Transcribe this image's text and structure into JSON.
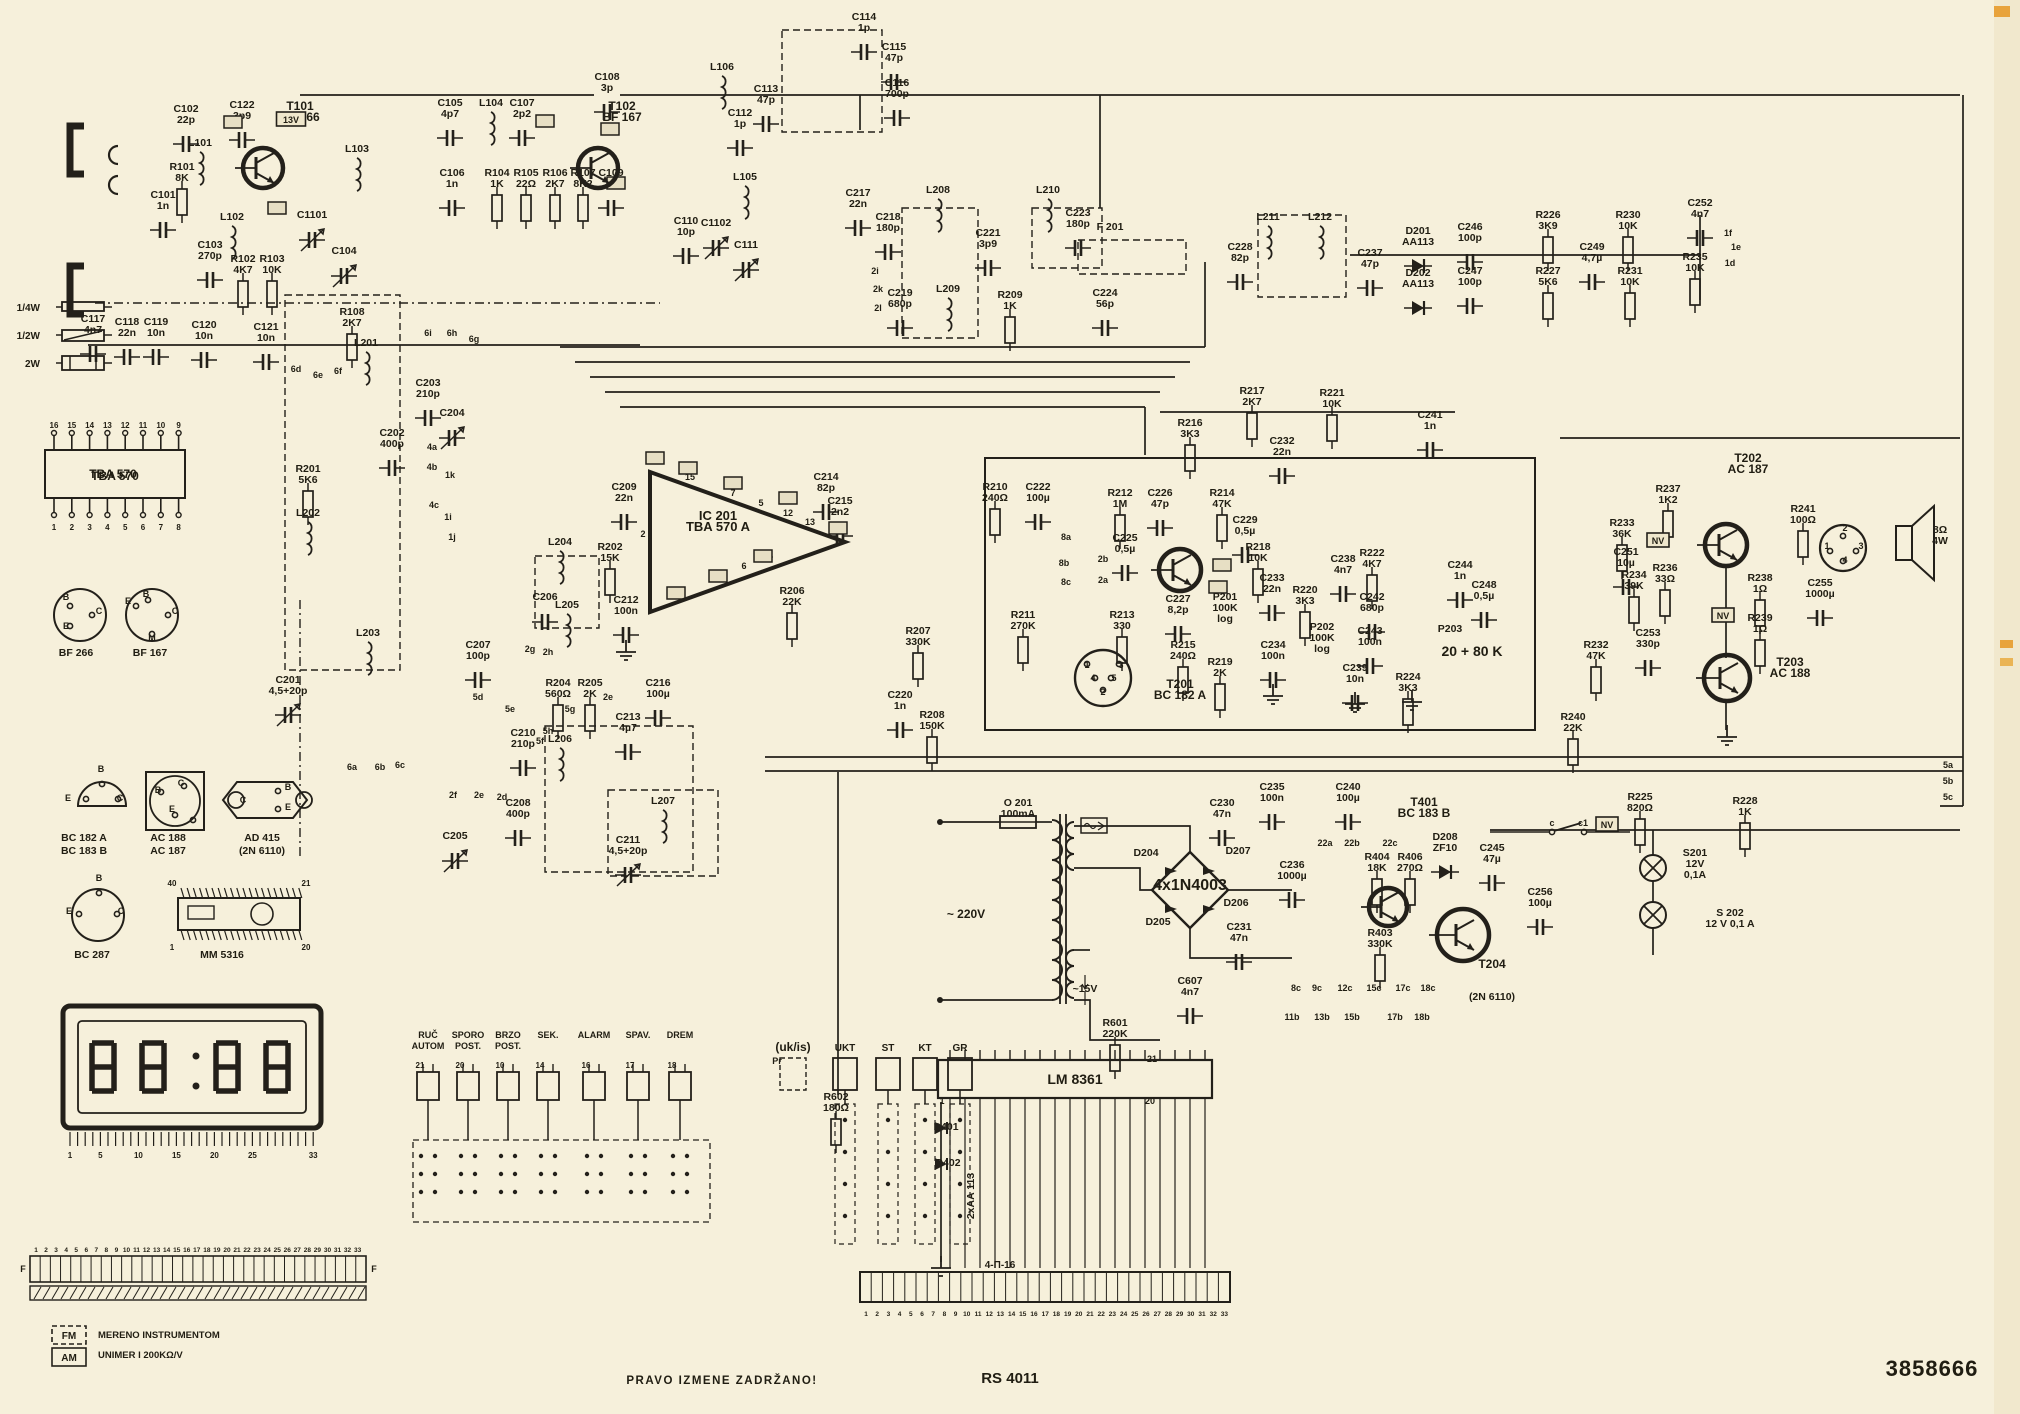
{
  "footer": {
    "note": "PRAVO  IZMENE  ZADRŽANO!",
    "model": "RS 4011",
    "number": "3858666"
  },
  "colors": {
    "paper": "#f6f0db",
    "ink": "#23201a",
    "accent_orange": "#e8a33c"
  },
  "display": {
    "value": "88:88",
    "scale": [
      "1",
      "5",
      "10",
      "15",
      "20",
      "25",
      "33"
    ]
  },
  "ics": {
    "tba570": {
      "label": "TBA 570",
      "pins_top": [
        "16",
        "15",
        "14",
        "13",
        "12",
        "11",
        "10",
        "9"
      ],
      "pins_bottom": [
        "1",
        "2",
        "3",
        "4",
        "5",
        "6",
        "7",
        "8"
      ]
    },
    "mm5316": {
      "label": "MM 5316",
      "pin_tl": "40",
      "pin_tr": "21",
      "pin_bl": "1",
      "pin_br": "20"
    },
    "lm8361": {
      "label": "LM 8361"
    }
  },
  "connectors": {
    "left_strip_numbers": [
      "1",
      "2",
      "3",
      "4",
      "5",
      "6",
      "7",
      "8",
      "9",
      "10",
      "11",
      "12",
      "13",
      "14",
      "15",
      "16",
      "17",
      "18",
      "19",
      "20",
      "21",
      "22",
      "23",
      "24",
      "25",
      "26",
      "27",
      "28",
      "29",
      "30",
      "31",
      "32",
      "33"
    ],
    "left_strip_end_letters": [
      "F",
      "F"
    ],
    "main_strip_numbers": [
      "1",
      "2",
      "3",
      "4",
      "5",
      "6",
      "7",
      "8",
      "9",
      "10",
      "11",
      "12",
      "13",
      "14",
      "15",
      "16",
      "17",
      "18",
      "19",
      "20",
      "21",
      "22",
      "23",
      "24",
      "25",
      "26",
      "27",
      "28",
      "29",
      "30",
      "31",
      "32",
      "33"
    ],
    "main_strip_tag": "4-Π-16"
  },
  "clock_switches": {
    "labels": [
      "RUČ|AUTOM",
      "SPORO|POST.",
      "BRZO|POST.",
      "SEK.",
      "ALARM",
      "SPAV.",
      "DREM"
    ],
    "pins": [
      "21",
      "20",
      "10",
      "14",
      "16",
      "17",
      "18"
    ]
  },
  "band_switches": {
    "prefix": "Pr",
    "group": "(uk/is)",
    "labels": [
      "UKT",
      "ST",
      "KT",
      "GR"
    ]
  },
  "legend": {
    "items": [
      "1/4W",
      "1/2W",
      "2W"
    ]
  },
  "meter_note": {
    "fm": "FM",
    "am": "AM",
    "line1": "MERENO  INSTRUMENTOM",
    "line2": "UNIMER I  200KΩ/V"
  },
  "voltage_tags": [
    [
      "13V",
      291,
      122
    ],
    [
      "NV",
      1658,
      543
    ],
    [
      "NV",
      1723,
      618
    ],
    [
      "NV",
      1607,
      827
    ]
  ],
  "empty_tags": [
    [
      233,
      122
    ],
    [
      545,
      121
    ],
    [
      610,
      129
    ],
    [
      277,
      208
    ],
    [
      616,
      183
    ],
    [
      655,
      458
    ],
    [
      688,
      468
    ],
    [
      733,
      483
    ],
    [
      788,
      498
    ],
    [
      838,
      528
    ],
    [
      763,
      556
    ],
    [
      718,
      576
    ],
    [
      676,
      593
    ],
    [
      1222,
      565
    ],
    [
      1218,
      587
    ]
  ],
  "labels": [
    [
      "C101|1n",
      163,
      198
    ],
    [
      "L101",
      200,
      146
    ],
    [
      "L102",
      232,
      220
    ],
    [
      "C102|22p",
      186,
      112
    ],
    [
      "C122|3p9",
      242,
      108
    ],
    [
      "R101|8K",
      182,
      170
    ],
    [
      "T101|BF 266",
      300,
      110,
      {
        "b": 1,
        "s": 12,
        "g": 0
      }
    ],
    [
      "C103|270p",
      210,
      248
    ],
    [
      "R102|4K7",
      243,
      262
    ],
    [
      "R103|10K",
      272,
      262
    ],
    [
      "L103",
      357,
      152
    ],
    [
      "C1101",
      312,
      218,
      {
        "g": "trim"
      }
    ],
    [
      "C104",
      344,
      254,
      {
        "g": "trim"
      }
    ],
    [
      "C117|4n7",
      93,
      322
    ],
    [
      "C118|22n",
      127,
      325
    ],
    [
      "C119|10n",
      156,
      325
    ],
    [
      "C120|10n",
      204,
      328
    ],
    [
      "C121|10n",
      266,
      330
    ],
    [
      "R108|2K7",
      352,
      315
    ],
    [
      "C105|4p7",
      450,
      106
    ],
    [
      "L104",
      491,
      106
    ],
    [
      "C107|2p2",
      522,
      106
    ],
    [
      "T102|BF 167",
      622,
      110,
      {
        "b": 1,
        "s": 12,
        "g": 0
      }
    ],
    [
      "C106|1n",
      452,
      176
    ],
    [
      "R104|1K",
      497,
      176
    ],
    [
      "R105|22Ω",
      526,
      176
    ],
    [
      "R106|2K7",
      555,
      176
    ],
    [
      "R107|8K2",
      583,
      176
    ],
    [
      "C109|1n",
      611,
      176
    ],
    [
      "C108|3p",
      607,
      80
    ],
    [
      "L106",
      722,
      70
    ],
    [
      "C113|47p",
      766,
      92
    ],
    [
      "C112|1p",
      740,
      116
    ],
    [
      "C114|1p",
      864,
      20
    ],
    [
      "C115|47p",
      894,
      50
    ],
    [
      "C116|700p",
      897,
      86
    ],
    [
      "L105",
      745,
      180
    ],
    [
      "C110|10p",
      686,
      224
    ],
    [
      "C1102",
      716,
      226,
      {
        "g": "trim"
      }
    ],
    [
      "C111",
      746,
      248,
      {
        "g": "trim"
      }
    ],
    [
      "C217|22n",
      858,
      196
    ],
    [
      "C218|180p",
      888,
      220
    ],
    [
      "L208",
      938,
      193
    ],
    [
      "C221|3p9",
      988,
      236
    ],
    [
      "L210",
      1048,
      193
    ],
    [
      "C223|180p",
      1078,
      216
    ],
    [
      "F 201",
      1110,
      230,
      {
        "b": 1,
        "g": 0
      }
    ],
    [
      "L209",
      948,
      292
    ],
    [
      "C219|680p",
      900,
      296
    ],
    [
      "R209|1K",
      1010,
      298
    ],
    [
      "C224|56p",
      1105,
      296
    ],
    [
      "C228|82p",
      1240,
      250
    ],
    [
      "L211",
      1268,
      220
    ],
    [
      "L212",
      1320,
      220
    ],
    [
      "C237|47p",
      1370,
      256
    ],
    [
      "D201|AA113",
      1418,
      234
    ],
    [
      "D202|AA113",
      1418,
      276
    ],
    [
      "C246|100p",
      1470,
      230
    ],
    [
      "C247|100p",
      1470,
      274
    ],
    [
      "R226|3K9",
      1548,
      218
    ],
    [
      "R227|5K6",
      1548,
      274
    ],
    [
      "C249|4,7µ",
      1592,
      250
    ],
    [
      "R230|10K",
      1628,
      218
    ],
    [
      "R231|10K",
      1630,
      274
    ],
    [
      "C252|4n7",
      1700,
      206
    ],
    [
      "R235|10K",
      1695,
      260
    ],
    [
      "1f",
      1728,
      236
    ],
    [
      "1e",
      1736,
      250
    ],
    [
      "1d",
      1730,
      266
    ],
    [
      "R216|3K3",
      1190,
      426
    ],
    [
      "R217|2K7",
      1252,
      394
    ],
    [
      "C232|22n",
      1282,
      444
    ],
    [
      "R221|10K",
      1332,
      396
    ],
    [
      "C241|1n",
      1430,
      418
    ],
    [
      "IC 201|TBA 570 A",
      718,
      520,
      {
        "b": 1,
        "s": 13,
        "g": 0
      }
    ],
    [
      "C209|22n",
      624,
      490
    ],
    [
      "R202|15K",
      610,
      550
    ],
    [
      "C212|100n",
      626,
      603
    ],
    [
      "C214|82p",
      826,
      480
    ],
    [
      "C215|2n2",
      840,
      504
    ],
    [
      "R206|22K",
      792,
      594
    ],
    [
      "1",
      649,
      463
    ],
    [
      "15",
      690,
      480
    ],
    [
      "7",
      733,
      496
    ],
    [
      "5",
      761,
      506
    ],
    [
      "12",
      788,
      516
    ],
    [
      "13",
      810,
      525
    ],
    [
      "14",
      768,
      559
    ],
    [
      "6",
      744,
      569
    ],
    [
      "16",
      715,
      581
    ],
    [
      "4",
      676,
      597
    ],
    [
      "2",
      643,
      537
    ],
    [
      "L201",
      366,
      346
    ],
    [
      "C203|210p",
      428,
      386
    ],
    [
      "C204",
      452,
      416,
      {
        "g": "trim"
      }
    ],
    [
      "C202|400p",
      392,
      436
    ],
    [
      "R201|5K6",
      308,
      472
    ],
    [
      "L202",
      308,
      516
    ],
    [
      "C201|4,5+20p",
      288,
      683,
      {
        "g": "trim"
      }
    ],
    [
      "L203",
      368,
      636
    ],
    [
      "L204",
      560,
      545
    ],
    [
      "C206",
      545,
      600
    ],
    [
      "L205",
      567,
      608
    ],
    [
      "R204|560Ω",
      558,
      686
    ],
    [
      "R205|2K",
      590,
      686
    ],
    [
      "C216|100µ",
      658,
      686
    ],
    [
      "C213|4µ7",
      628,
      720
    ],
    [
      "C207|100p",
      478,
      648
    ],
    [
      "C210|210p",
      523,
      736
    ],
    [
      "L206",
      560,
      742
    ],
    [
      "L207",
      663,
      804
    ],
    [
      "C205",
      455,
      839,
      {
        "g": "trim"
      }
    ],
    [
      "C208|400p",
      518,
      806
    ],
    [
      "C211|4,5+20p",
      628,
      843,
      {
        "g": "trim"
      }
    ],
    [
      "6i",
      428,
      336
    ],
    [
      "6h",
      452,
      336
    ],
    [
      "6g",
      474,
      342
    ],
    [
      "6d",
      296,
      372
    ],
    [
      "6e",
      318,
      378
    ],
    [
      "6f",
      338,
      374
    ],
    [
      "4a",
      432,
      450
    ],
    [
      "4b",
      432,
      470
    ],
    [
      "4c",
      434,
      508
    ],
    [
      "1k",
      450,
      478
    ],
    [
      "1i",
      448,
      520
    ],
    [
      "1j",
      452,
      540
    ],
    [
      "2g",
      530,
      652
    ],
    [
      "2h",
      548,
      655
    ],
    [
      "2e",
      608,
      700
    ],
    [
      "5d",
      478,
      700
    ],
    [
      "5e",
      510,
      712
    ],
    [
      "5g",
      570,
      712
    ],
    [
      "5h",
      548,
      734
    ],
    [
      "5f",
      540,
      744
    ],
    [
      "6a",
      352,
      770
    ],
    [
      "6b",
      380,
      770
    ],
    [
      "6c",
      400,
      768
    ],
    [
      "2f",
      453,
      798
    ],
    [
      "2e",
      479,
      798
    ],
    [
      "2d",
      502,
      800
    ],
    [
      "2i",
      875,
      274
    ],
    [
      "2k",
      878,
      292
    ],
    [
      "2l",
      878,
      311
    ],
    [
      "8a",
      1066,
      540
    ],
    [
      "8b",
      1064,
      566
    ],
    [
      "8c",
      1066,
      585
    ],
    [
      "2b",
      1103,
      562
    ],
    [
      "2a",
      1103,
      583
    ],
    [
      "R210|240Ω",
      995,
      490
    ],
    [
      "C222|100µ",
      1038,
      490
    ],
    [
      "R212|1M",
      1120,
      496
    ],
    [
      "C226|47p",
      1160,
      496
    ],
    [
      "R214|47K",
      1222,
      496
    ],
    [
      "C225|0,5µ",
      1125,
      541
    ],
    [
      "C229|0,5µ",
      1245,
      523
    ],
    [
      "R218|10K",
      1258,
      550
    ],
    [
      "P201|100K|log",
      1225,
      600,
      {
        "g": 0
      }
    ],
    [
      "C233|22n",
      1272,
      581
    ],
    [
      "R220|3K3",
      1305,
      593
    ],
    [
      "C234|100n",
      1273,
      648
    ],
    [
      "R219|2K",
      1220,
      665
    ],
    [
      "R211|270K",
      1023,
      618
    ],
    [
      "R213|330",
      1122,
      618
    ],
    [
      "C227|8,2p",
      1178,
      602
    ],
    [
      "R215|240Ω",
      1183,
      648
    ],
    [
      "T201|BC 182 A",
      1180,
      688,
      {
        "b": 1,
        "s": 12,
        "g": 0
      }
    ],
    [
      "P202|100K|log",
      1322,
      630,
      {
        "g": 0
      }
    ],
    [
      "C239|10n",
      1355,
      671
    ],
    [
      "C238|4n7",
      1343,
      562
    ],
    [
      "R222|4K7",
      1372,
      556
    ],
    [
      "C242|680p",
      1372,
      600
    ],
    [
      "C243|100n",
      1370,
      634
    ],
    [
      "R224|3K3",
      1408,
      680
    ],
    [
      "C244|1n",
      1460,
      568
    ],
    [
      "C248|0,5µ",
      1484,
      588
    ],
    [
      "P203",
      1450,
      632,
      {
        "g": 0
      }
    ],
    [
      "20 + 80 K",
      1472,
      656,
      {
        "b": 1,
        "s": 14,
        "g": 0
      }
    ],
    [
      "R207|330K",
      918,
      634
    ],
    [
      "C220|1n",
      900,
      698
    ],
    [
      "R208|150K",
      932,
      718
    ],
    [
      "1",
      1087,
      668
    ],
    [
      "3",
      1121,
      668
    ],
    [
      "4",
      1093,
      681
    ],
    [
      "5",
      1114,
      681
    ],
    [
      "2",
      1103,
      695
    ],
    [
      "T202|AC 187",
      1748,
      462,
      {
        "b": 1,
        "s": 12,
        "g": 0
      }
    ],
    [
      "R237|1K2",
      1668,
      492
    ],
    [
      "R233|36K",
      1622,
      526
    ],
    [
      "C251|10µ",
      1626,
      555
    ],
    [
      "R234|39K",
      1634,
      578
    ],
    [
      "R236|33Ω",
      1665,
      571
    ],
    [
      "R238|1Ω",
      1760,
      581
    ],
    [
      "C255|1000µ",
      1820,
      586
    ],
    [
      "R241|100Ω",
      1803,
      512
    ],
    [
      "8Ω|4W",
      1940,
      533,
      {
        "g": 0
      }
    ],
    [
      "T203|AC 188",
      1790,
      666,
      {
        "b": 1,
        "s": 12,
        "g": 0
      }
    ],
    [
      "R239|1Ω",
      1760,
      621
    ],
    [
      "C253|330p",
      1648,
      636
    ],
    [
      "R232|47K",
      1596,
      648
    ],
    [
      "R240|22K",
      1573,
      720
    ],
    [
      "2",
      1845,
      531
    ],
    [
      "1",
      1827,
      549
    ],
    [
      "3",
      1861,
      549
    ],
    [
      "4",
      1845,
      563
    ],
    [
      "O 201|100mA",
      1018,
      806,
      {
        "g": 0
      }
    ],
    [
      "~ 220V",
      966,
      918,
      {
        "s": 12,
        "g": 0
      }
    ],
    [
      "D204",
      1146,
      856,
      {
        "g": 0
      }
    ],
    [
      "D207",
      1238,
      854,
      {
        "g": 0
      }
    ],
    [
      "D205",
      1158,
      925,
      {
        "g": 0
      }
    ],
    [
      "D206",
      1236,
      906,
      {
        "g": 0
      }
    ],
    [
      "4x1N4003",
      1190,
      890,
      {
        "b": 1,
        "s": 16,
        "g": 0
      }
    ],
    [
      "C230|47n",
      1222,
      806
    ],
    [
      "C231|47n",
      1239,
      930
    ],
    [
      "C235|100n",
      1272,
      790
    ],
    [
      "C240|100µ",
      1348,
      790
    ],
    [
      "T401|BC 183 B",
      1424,
      806,
      {
        "b": 1,
        "s": 12,
        "g": 0
      }
    ],
    [
      "~15V",
      1085,
      992,
      {
        "g": 0
      }
    ],
    [
      "C607|4n7",
      1190,
      984
    ],
    [
      "R601|220K",
      1115,
      1026
    ],
    [
      "C236|1000µ",
      1292,
      868
    ],
    [
      "R404|18K",
      1377,
      860
    ],
    [
      "R406|270Ω",
      1410,
      860
    ],
    [
      "R403|330K",
      1380,
      936
    ],
    [
      "D208|ZF10",
      1445,
      840
    ],
    [
      "C245|47µ",
      1492,
      851
    ],
    [
      "C256|100µ",
      1540,
      895
    ],
    [
      "T204",
      1492,
      968,
      {
        "b": 1,
        "s": 12,
        "g": 0
      }
    ],
    [
      "(2N 6110)",
      1492,
      1000,
      {
        "b": 1,
        "g": 0
      }
    ],
    [
      "R225|820Ω",
      1640,
      800
    ],
    [
      "R228|1K",
      1745,
      804
    ],
    [
      "S201|12V|0,1A",
      1695,
      856,
      {
        "g": 0
      }
    ],
    [
      "S 202|12 V 0,1 A",
      1730,
      916,
      {
        "g": 0
      }
    ],
    [
      "c",
      1552,
      826
    ],
    [
      "c1",
      1583,
      826
    ],
    [
      "5a",
      1948,
      768
    ],
    [
      "5b",
      1948,
      784
    ],
    [
      "5c",
      1948,
      800
    ],
    [
      "22a",
      1325,
      846
    ],
    [
      "22b",
      1352,
      846
    ],
    [
      "22c",
      1390,
      846
    ],
    [
      "8c",
      1296,
      991
    ],
    [
      "9c",
      1317,
      991
    ],
    [
      "12c",
      1345,
      991
    ],
    [
      "15c",
      1374,
      991
    ],
    [
      "17c",
      1403,
      991
    ],
    [
      "18c",
      1428,
      991
    ],
    [
      "11b",
      1292,
      1020
    ],
    [
      "13b",
      1322,
      1020
    ],
    [
      "15b",
      1352,
      1020
    ],
    [
      "17b",
      1395,
      1020
    ],
    [
      "18b",
      1422,
      1020
    ],
    [
      "21",
      1152,
      1062
    ],
    [
      "1",
      942,
      1104
    ],
    [
      "20",
      1150,
      1104
    ],
    [
      "D401",
      946,
      1130,
      {
        "g": 0
      }
    ],
    [
      "D402",
      948,
      1166,
      {
        "g": 0
      }
    ],
    [
      "2xAA 113",
      974,
      1196,
      {
        "g": 0,
        "r": -90
      }
    ],
    [
      "R602|180Ω",
      836,
      1100
    ],
    [
      "TBA 570",
      113,
      478,
      {
        "b": 1,
        "s": 12,
        "g": 0
      }
    ],
    [
      "BF 266",
      76,
      656,
      {
        "g": 0
      }
    ],
    [
      "BF 167",
      150,
      656,
      {
        "g": 0
      }
    ],
    [
      "BC 182 A",
      84,
      841,
      {
        "g": 0
      }
    ],
    [
      "BC 183 B",
      84,
      854,
      {
        "g": 0
      }
    ],
    [
      "AC 188",
      168,
      841,
      {
        "g": 0
      }
    ],
    [
      "AC 187",
      168,
      854,
      {
        "g": 0
      }
    ],
    [
      "AD 415",
      262,
      841,
      {
        "g": 0
      }
    ],
    [
      "(2N 6110)",
      262,
      854,
      {
        "g": 0
      }
    ],
    [
      "BC 287",
      92,
      958,
      {
        "g": 0
      }
    ],
    [
      "MM 5316",
      222,
      958,
      {
        "g": 0
      }
    ],
    [
      "B",
      66,
      600
    ],
    [
      "C",
      99,
      614
    ],
    [
      "E",
      66,
      629
    ],
    [
      "E",
      128,
      604
    ],
    [
      "B",
      146,
      597
    ],
    [
      "C",
      175,
      614
    ],
    [
      "M",
      152,
      641
    ],
    [
      "E",
      68,
      801
    ],
    [
      "B",
      101,
      772
    ],
    [
      "C",
      120,
      801
    ],
    [
      "B",
      158,
      793
    ],
    [
      "C",
      181,
      786
    ],
    [
      "E",
      172,
      812
    ],
    [
      "C",
      243,
      803
    ],
    [
      "B",
      288,
      790
    ],
    [
      "E",
      288,
      810
    ],
    [
      "B",
      99,
      881
    ],
    [
      "E",
      69,
      914
    ],
    [
      "C",
      121,
      914
    ]
  ]
}
